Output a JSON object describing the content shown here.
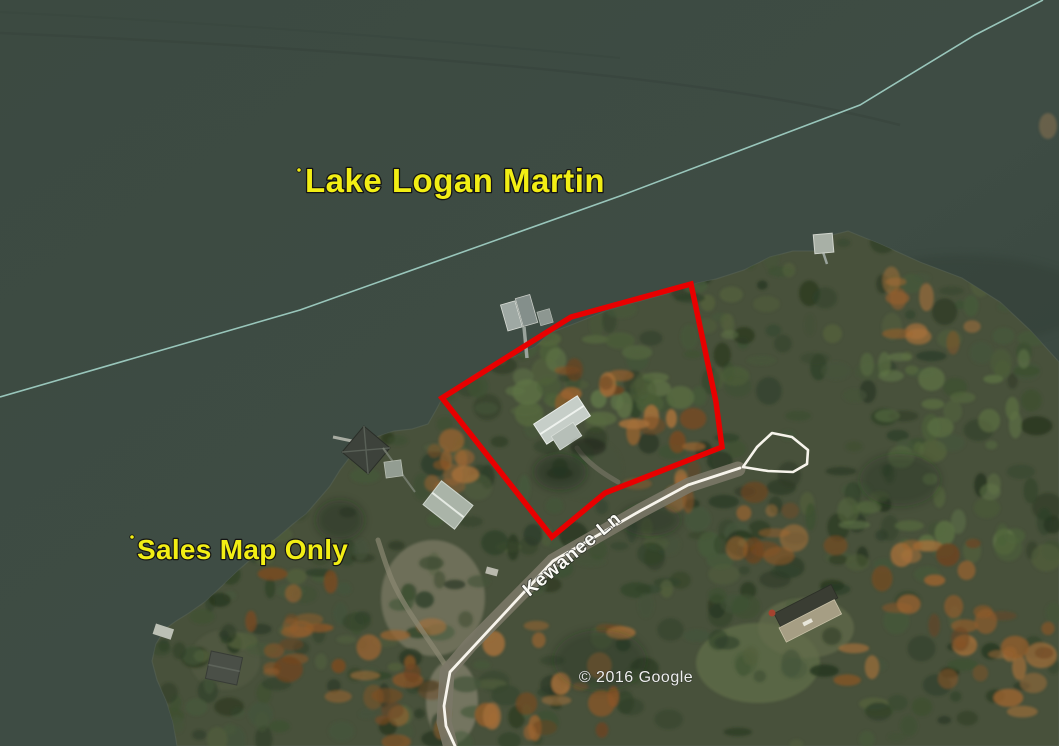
{
  "title": "Lake Logan Martin sales map (aerial)",
  "labels": {
    "lake_name": "Lake Logan Martin",
    "watermark": "Sales Map Only",
    "road_name": "Kewanee Ln",
    "attribution": "© 2016 Google"
  },
  "colors": {
    "water": "#3d4b42",
    "label_yellow": "#f2ee14",
    "parcel_red": "#e80000",
    "road_white": "#f7f4ec",
    "survey_teal": "#a9dcd0",
    "road_label_white": "#fbfbf6",
    "attribution_white": "#ededed"
  },
  "overlays": {
    "parcel": {
      "points": "442,398 571,317 691,284 716,402 722,447 605,493 552,537"
    },
    "road_centerline": {
      "points": "455,746 446,726 444,706 450,672 553,561 640,511 688,485 740,468"
    },
    "road_loop": {
      "points": "743,467 757,447 772,433 792,437 808,450 807,464 793,472 768,471 743,467"
    },
    "survey_line": {
      "points": "0,397 300,310 620,196 860,105 975,35 1043,0"
    }
  }
}
